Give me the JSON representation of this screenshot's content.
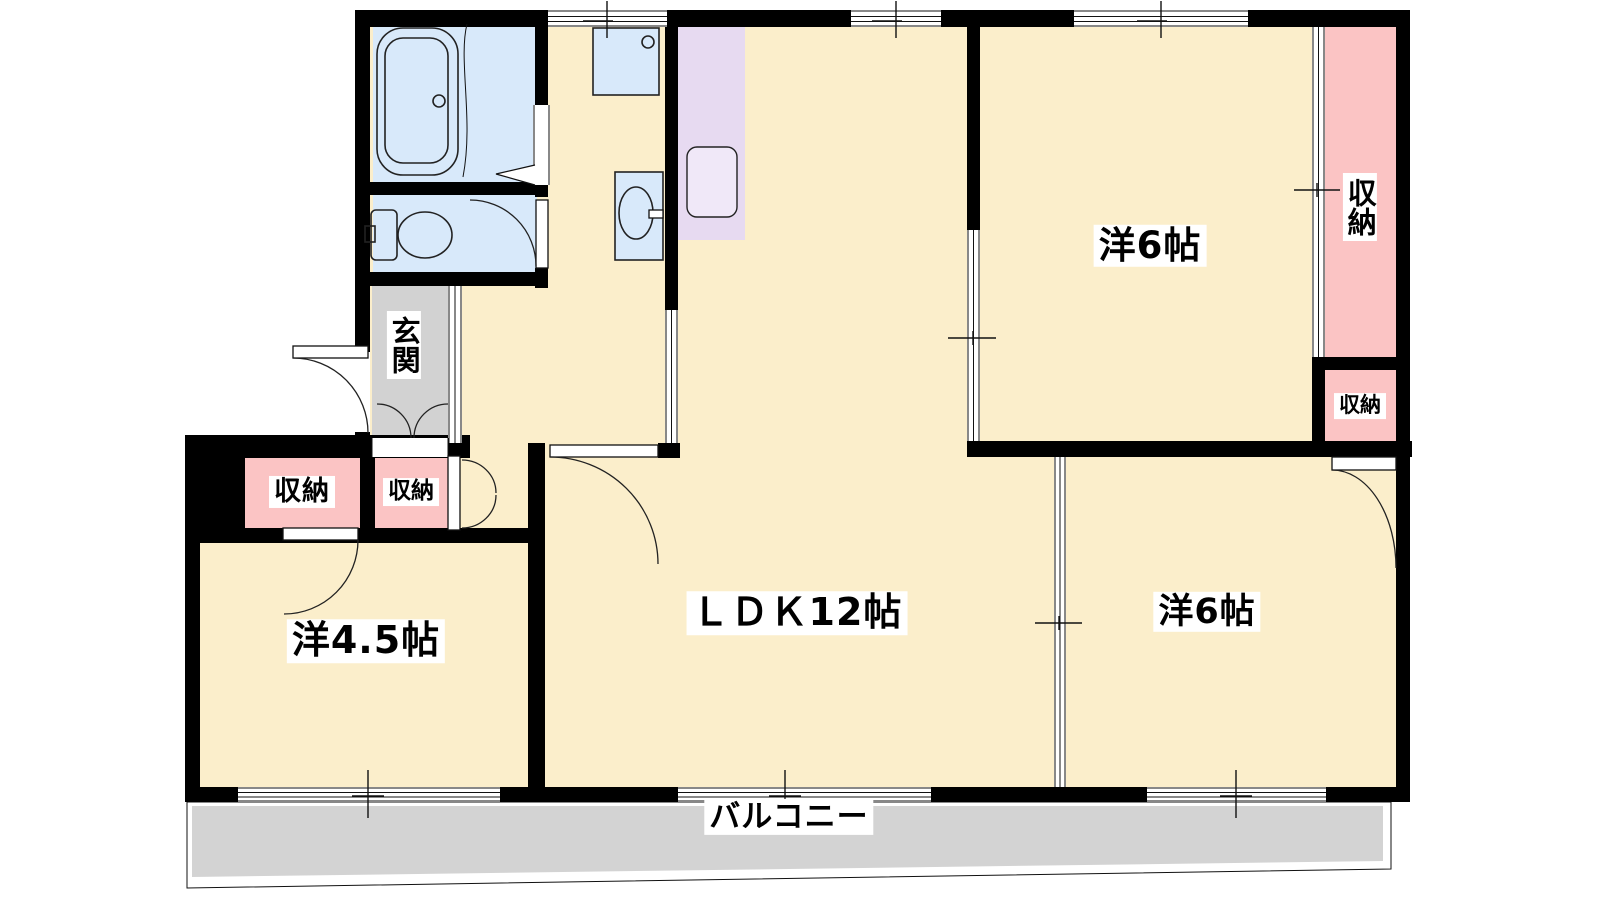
{
  "labels": {
    "ldk": "ＬＤＫ12帖",
    "bedroom_ne": "洋6帖",
    "bedroom_se": "洋6帖",
    "bedroom_w": "洋4.5帖",
    "entrance": "玄関",
    "closet_tall": "収納",
    "closet_small": "収納",
    "closet_w1": "収納",
    "closet_w2": "収納",
    "balcony": "バルコニー"
  },
  "colors": {
    "floor_cream": "#FBEECB",
    "closet_pink": "#FBC4C4",
    "sanitary_blue": "#D8E9FA",
    "kitchen_purple": "#E7DAF1",
    "entrance_gray": "#D2D2D2",
    "balcony_gray": "#D3D3D3",
    "wall_black": "#000000"
  }
}
